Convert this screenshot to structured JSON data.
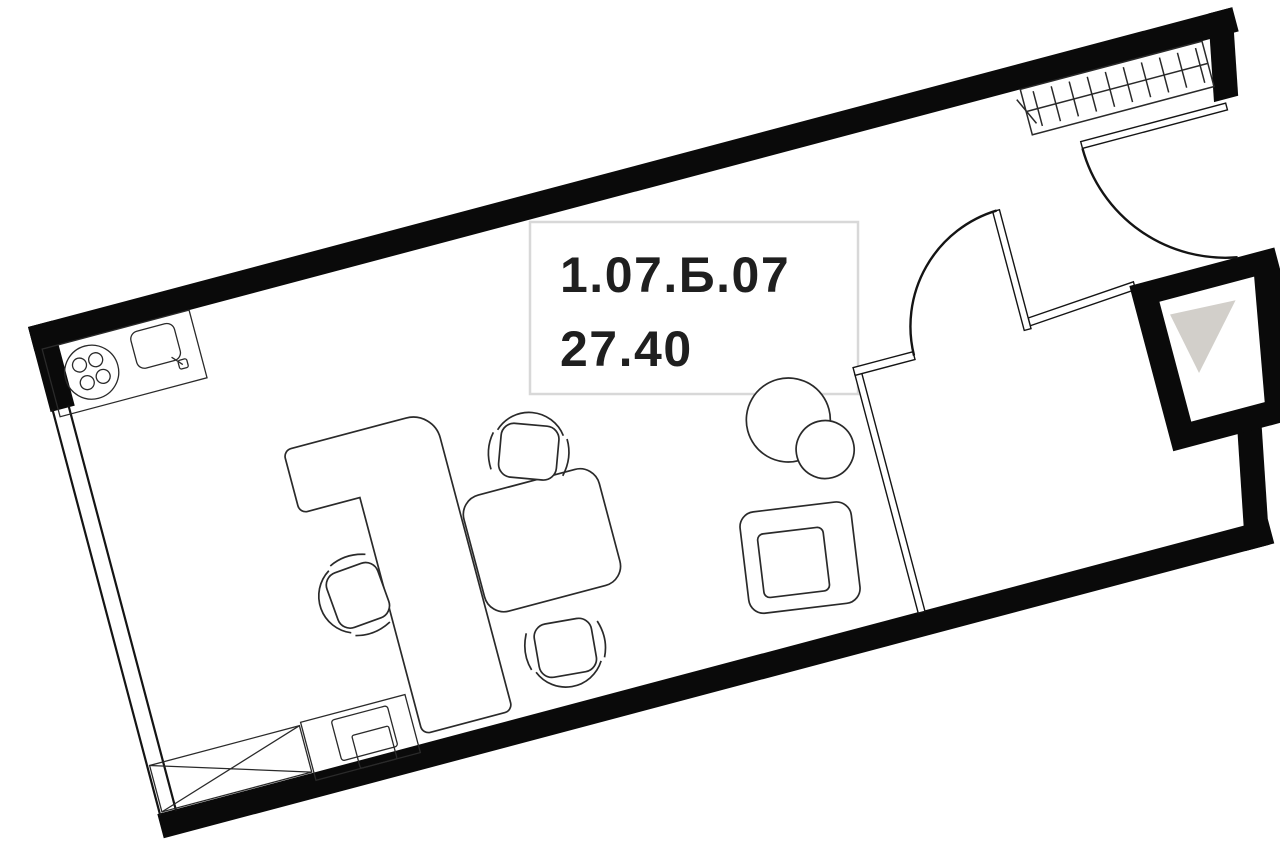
{
  "document": {
    "kind": "apartment-floor-plan"
  },
  "unit": {
    "number": "1.07.Б.07",
    "area": "27.40"
  },
  "colors": {
    "background": "#ffffff",
    "walls": "#0a0a0a",
    "furniture_line": "#2a2a2a",
    "thin_wall_line": "#141414",
    "label_border": "#d8d8d8",
    "label_text": "#1f1f1f",
    "shaft_triangle": "#d2cfca"
  },
  "elements": {
    "windows": [
      "left-facade-window",
      "top-right-grille"
    ],
    "doors": [
      "entry-door",
      "room-door"
    ],
    "shaft": "ventilation-shaft",
    "kitchen": [
      "kitchen-counter",
      "washing-machine-icon",
      "sink-icon"
    ],
    "furniture": [
      "l-shaped-desk",
      "office-chair-left",
      "office-chair-top",
      "office-chair-bottom",
      "meeting-table",
      "round-table",
      "pouf",
      "armchair",
      "wardrobe",
      "printer-cabinet",
      "printer-icon"
    ]
  }
}
